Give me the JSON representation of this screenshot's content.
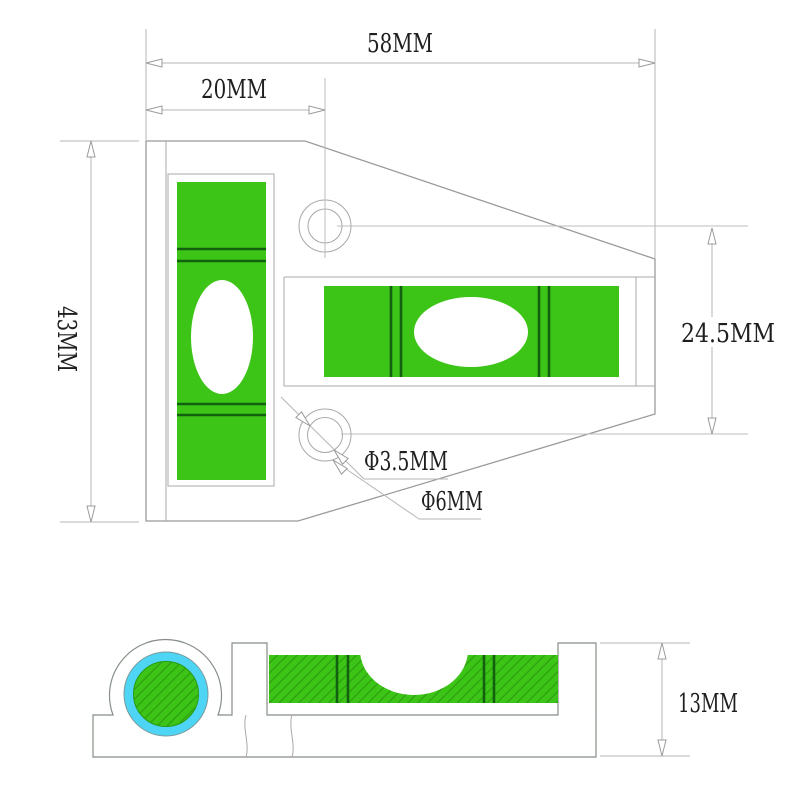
{
  "drawing": {
    "title": "bubble-spirit-level-technical-drawing",
    "views": {
      "top_view": "top view with vertical vial, horizontal vial, two mounting holes",
      "section_view": "cross-section with circular vial and horizontal vial"
    }
  },
  "labels": {
    "width_total": "58MM",
    "width_hole": "20MM",
    "height_total": "43MM",
    "hole_spacing": "24.5MM",
    "hole_diameter_inner": "Φ3.5MM",
    "hole_diameter_outer": "Φ6MM",
    "thickness": "13MM"
  },
  "colors": {
    "vial_green": "#3cc516",
    "vial_hatch_green": "#2ea00f",
    "ring_cyan": "#4ed4f4",
    "graduation_dark_green": "#116111",
    "outline_gray": "#9b9b9b",
    "section_outline_gray": "#868e86",
    "dimension_gray": "#b6b6b6",
    "hatch_gray": "#bbbbbb",
    "bubble_white": "#ffffff",
    "text_color": "#1f1f1f",
    "background": "#ffffff"
  }
}
